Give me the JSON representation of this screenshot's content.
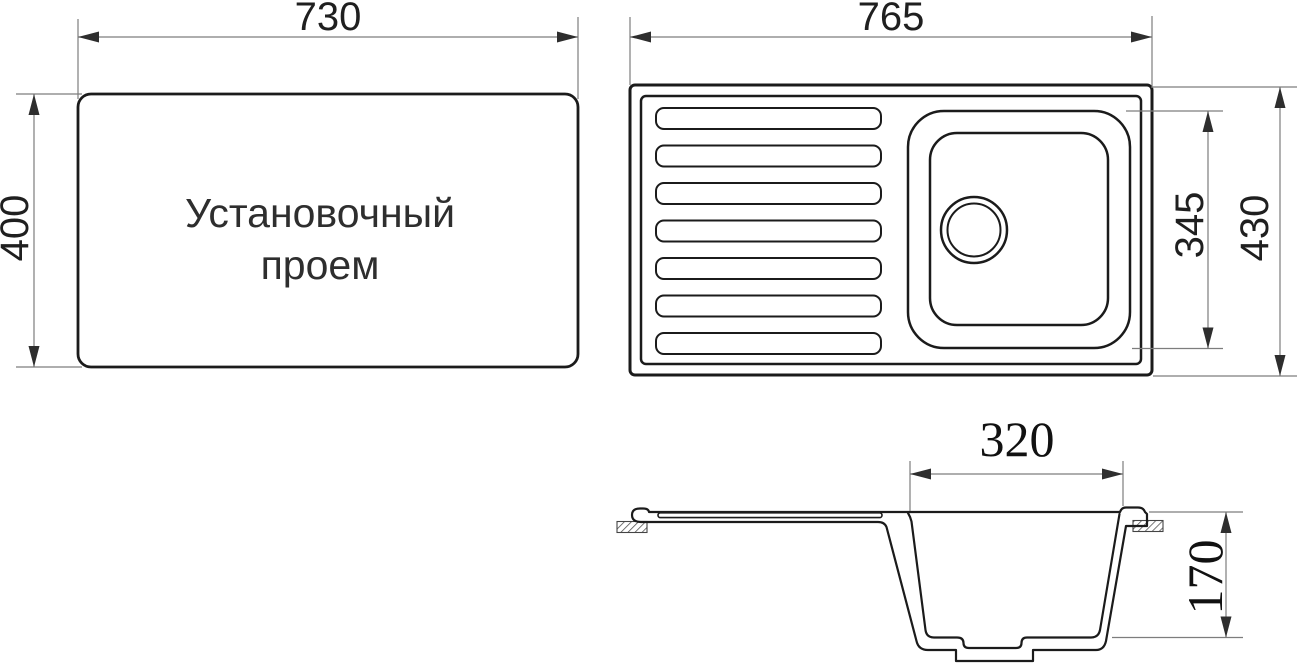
{
  "views": {
    "installation_opening": {
      "label_line1": "Установочный",
      "label_line2": "проем",
      "width_label": "730",
      "height_label": "400"
    },
    "sink_top_view": {
      "width_label": "765",
      "overall_depth_label": "430",
      "bowl_depth_label": "345"
    },
    "sink_section_view": {
      "bowl_width_label": "320",
      "bowl_depth_label": "170"
    }
  },
  "colors": {
    "background": "#ffffff",
    "outline": "#1b1b1b",
    "dimension_line": "#7d7d7d",
    "arrow": "#2e2e2e",
    "dimension_text": "#1f1f1f",
    "label_text": "#2e2e2e"
  }
}
